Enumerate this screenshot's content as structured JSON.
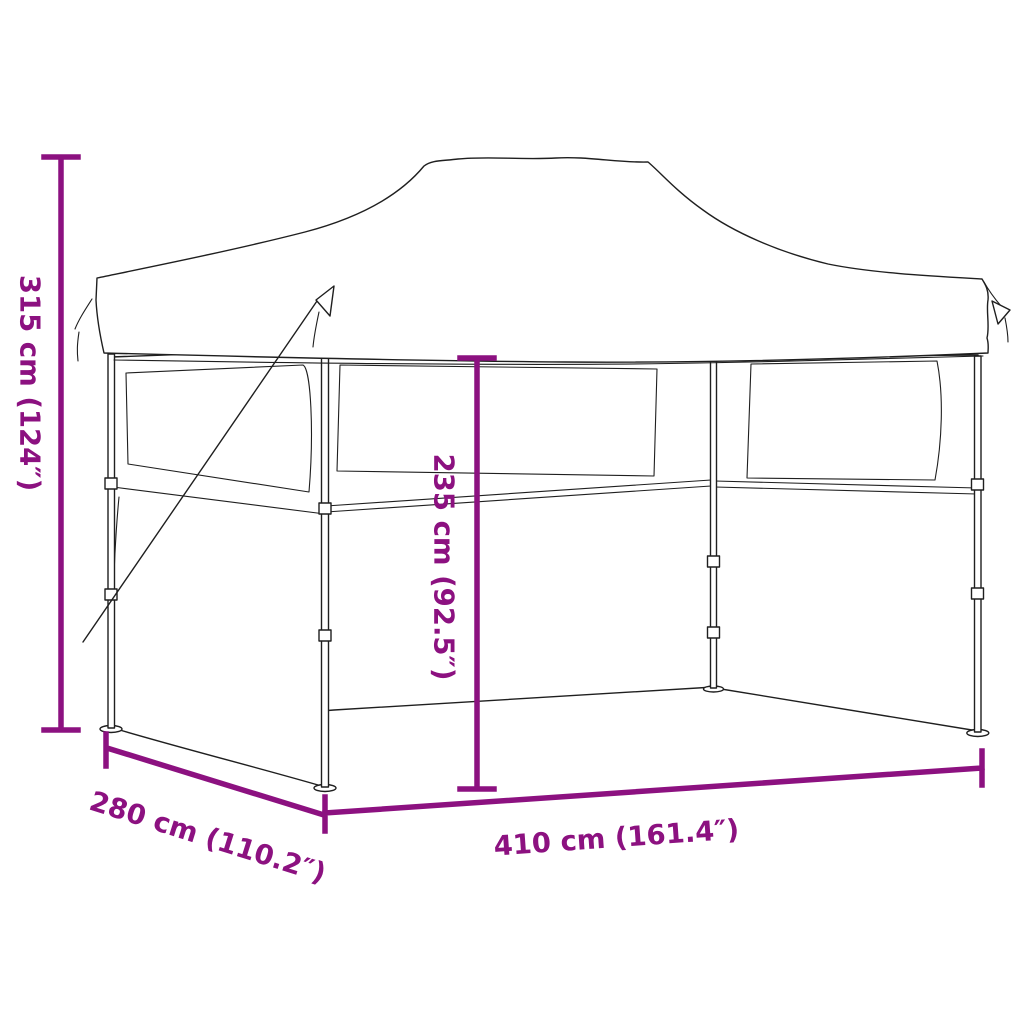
{
  "title": "Foldable party tent dimension diagram",
  "diagram": {
    "background_color": "#ffffff",
    "accent_color": "#8C1180",
    "line_color": "#1f1f1f",
    "product": "Pop-up folding party tent with sidewalls",
    "measurements": {
      "total_height": {
        "label": "315 cm (124″)",
        "value_cm": 315,
        "value_inch": 124,
        "orientation": "vertical-left"
      },
      "inner_height": {
        "label": "235 cm (92.5″)",
        "value_cm": 235,
        "value_inch": 92.5,
        "orientation": "vertical-center"
      },
      "width": {
        "label": "410 cm (161.4″)",
        "value_cm": 410,
        "value_inch": 161.4,
        "orientation": "horizontal-bottom"
      },
      "depth": {
        "label": "280 cm (110.2″)",
        "value_cm": 280,
        "value_inch": 110.2,
        "orientation": "diagonal-bottom-left"
      }
    }
  }
}
